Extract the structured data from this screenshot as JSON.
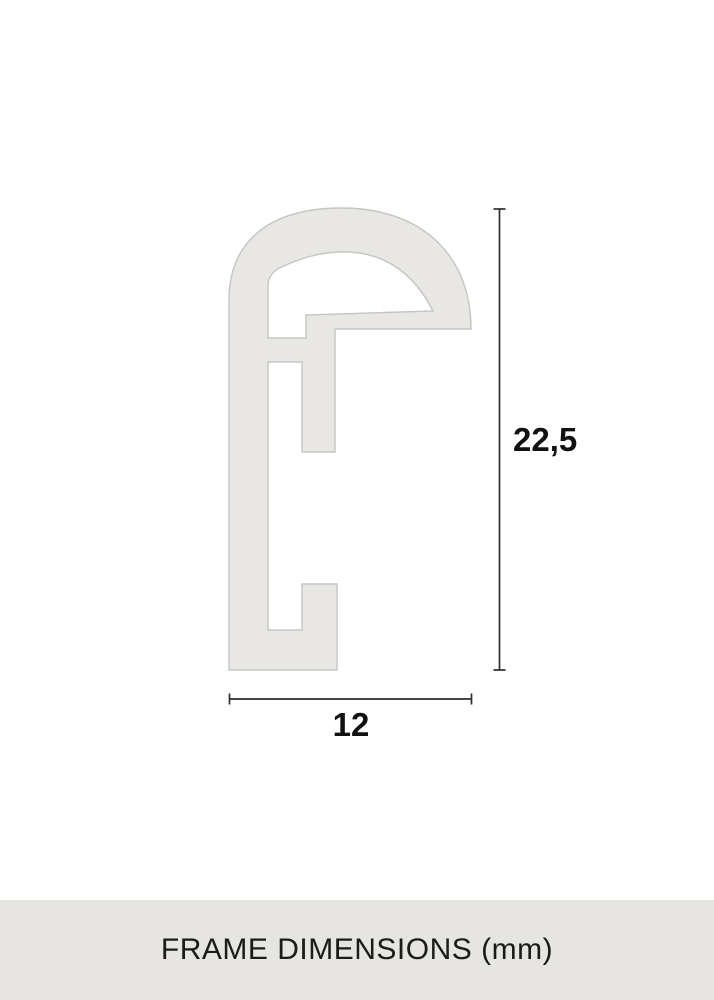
{
  "diagram": {
    "name": "Frame profile cross-section drawing",
    "height_dimension": {
      "label": "22,5"
    },
    "width_dimension": {
      "label": "12"
    },
    "colors": {
      "background": "#ffffff",
      "shape_fill": "#e8e7e3",
      "shape_stroke": "#c6c5c1",
      "dimension_line": "#2e2e2c",
      "dimension_text": "#111111"
    }
  },
  "footer": {
    "label": "FRAME DIMENSIONS (mm)",
    "background": "#e6e5e1",
    "text_color": "#1b1b19"
  }
}
